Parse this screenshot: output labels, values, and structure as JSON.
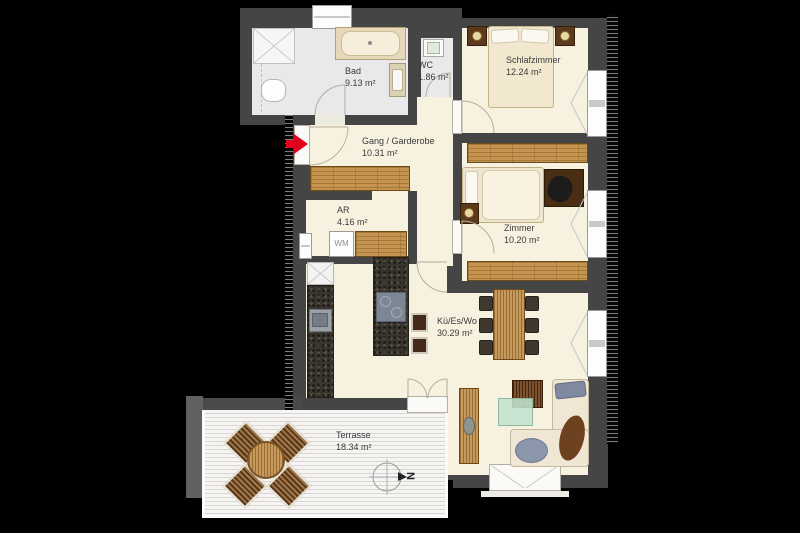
{
  "title": "Apartment floor plan",
  "rooms": {
    "bad": {
      "name": "Bad",
      "area": "9.13 m²"
    },
    "wc": {
      "name": "WC",
      "area": "1.86 m²"
    },
    "schlafzimmer": {
      "name": "Schlafzimmer",
      "area": "12.24 m²"
    },
    "gang": {
      "name": "Gang / Garderobe",
      "area": "10.31 m²"
    },
    "ar": {
      "name": "AR",
      "area": "4.16 m²"
    },
    "zimmer": {
      "name": "Zimmer",
      "area": "10.20 m²"
    },
    "kitchen_living": {
      "name": "Kü/Es/Wo",
      "area": "30.29 m²"
    },
    "terrasse": {
      "name": "Terrasse",
      "area": "18.34 m²"
    }
  },
  "labels": {
    "washing_machine": "WM",
    "compass_north": "N"
  },
  "colors": {
    "background": "#000000",
    "wall": "#454545",
    "floor": "#f7f1e0",
    "bath_floor": "#e9e9ea",
    "wood": "#c59550",
    "granite": "#39342c",
    "terrace_deck": "#f6f5f3",
    "entrance_arrow": "#e1001a"
  }
}
